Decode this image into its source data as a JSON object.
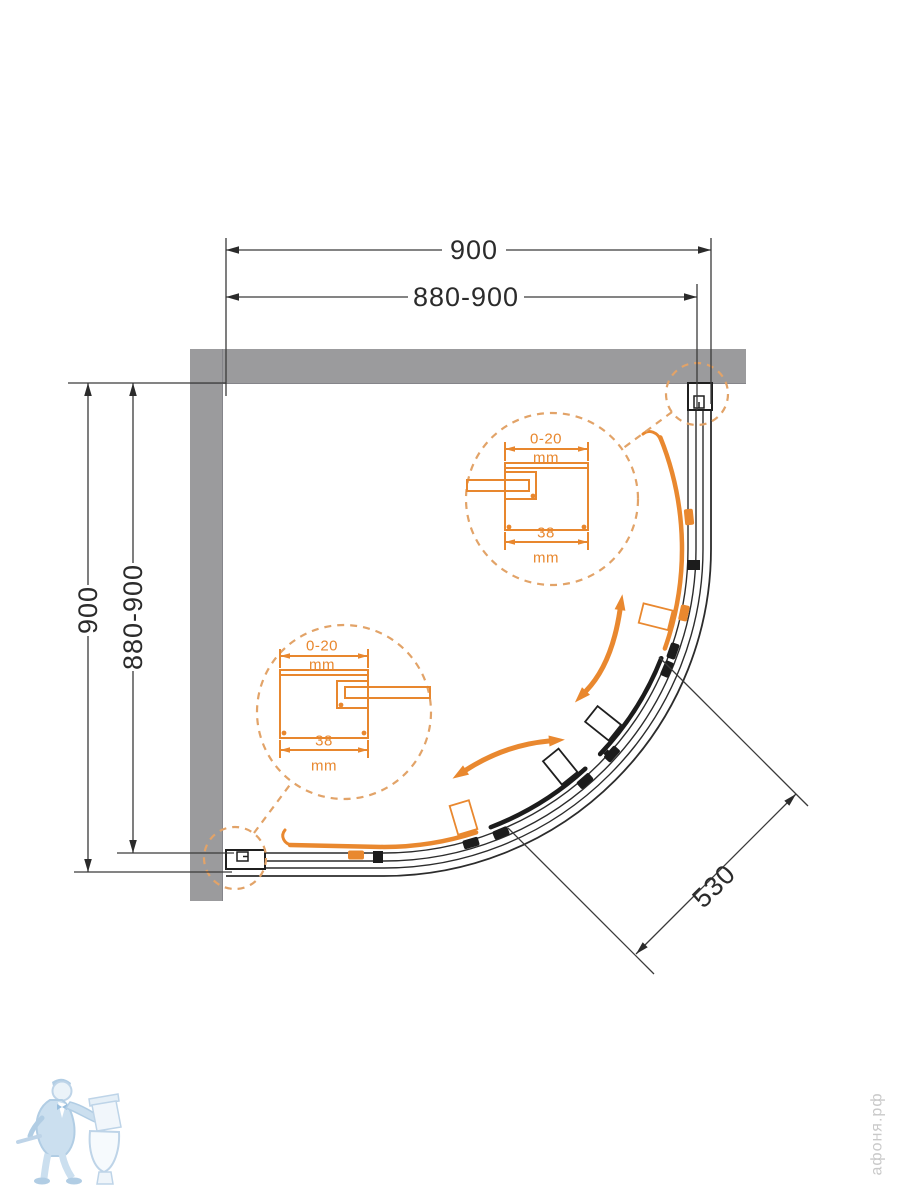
{
  "dims": {
    "width_overall": "900",
    "width_adjust": "880-900",
    "depth_overall": "900",
    "depth_adjust": "880-900",
    "door_opening": "530"
  },
  "detail_top": {
    "gap": "0-20",
    "gap_unit": "mm",
    "profile_width": "38",
    "profile_unit": "mm"
  },
  "detail_bottom": {
    "gap": "0-20",
    "gap_unit": "mm",
    "profile_width": "38",
    "profile_unit": "mm"
  },
  "watermark": {
    "site": "афоня.рф"
  },
  "colors": {
    "wall": "#9B9B9D",
    "line": "#2C2C2C",
    "door_dark": "#1C1C1C",
    "accent": "#E9882F",
    "accent_dashed": "#E2A368",
    "dim_text": "#2B2B2B",
    "watermark_blue": "#B7D0E6",
    "watermark_text": "#C9C9C9"
  }
}
